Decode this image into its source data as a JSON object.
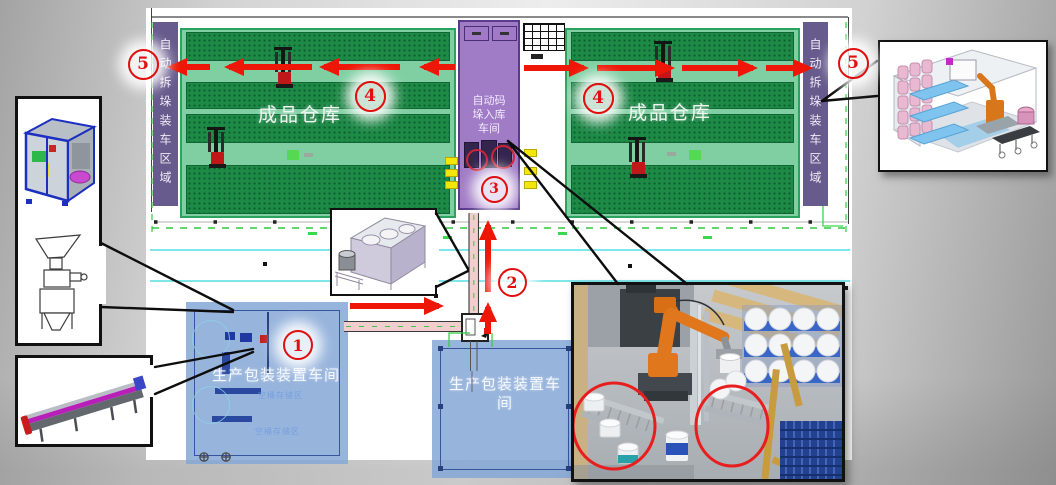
{
  "page": {
    "background": "gray-gradient-slide",
    "kind": "factory-logistics-layout-diagram"
  },
  "labels": {
    "depal_zone": "自动拆垛装车区域",
    "warehouse": "成品仓库",
    "palletizing_line1": "自动码",
    "palletizing_line2": "垛入库",
    "palletizing_line3": "车间",
    "palletizing_full": "自动码垛入库车间",
    "production_workshop": "生产包装装置车间",
    "production_workshop2_line1": "生产包装装置车",
    "production_workshop2_line2": "间",
    "storage_area_faint": "空桶存储区"
  },
  "markers": {
    "n1": "1",
    "n2": "2",
    "n3": "3",
    "n4": "4",
    "n5": "5"
  },
  "icons": {
    "forklift": "forklift-icon",
    "palletizer_robot": "palletizer-robot-icon",
    "pallet_grid": "pallet-grid-icon",
    "tank_conveyor": "tank-conveyor-3d-icon",
    "packaging_machine": "packaging-machine-3d-icon",
    "hopper_filler": "hopper-filler-drawing-icon",
    "belt_conveyor": "belt-conveyor-3d-icon",
    "depalletizing_cell": "depalletizing-cell-3d-icon",
    "robot_photo": "robot-arm-buckets-photo"
  },
  "colors": {
    "flow_arrow_red": "#ee1606",
    "marker_red": "#e30f0f",
    "zone_purple": "#675a8c",
    "center_purple": "#9a6cc4",
    "rack_green": "#1d8a46",
    "aisle_green": "#80cfa3",
    "workshop_blue": "#85a7d6",
    "cad_green": "#2ecc3e",
    "cad_cyan": "#55dde4",
    "pallet_blue": "#24418f",
    "robot_orange": "#e0771c"
  }
}
